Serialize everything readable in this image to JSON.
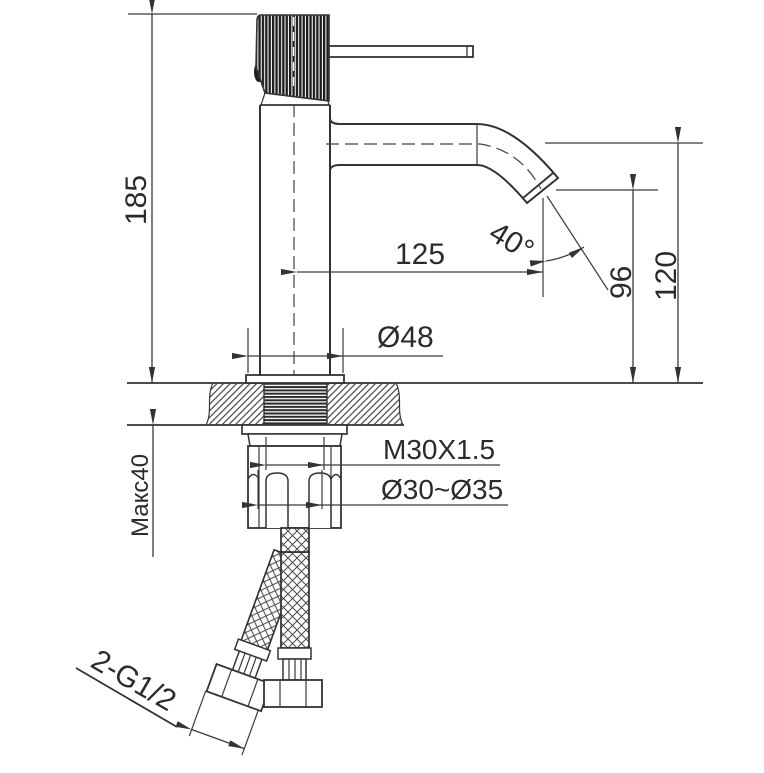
{
  "drawing": {
    "background_color": "#ffffff",
    "line_color": "#333333",
    "text_color": "#2b2b2b",
    "subject": "single-lever basin faucet, front elevation with countertop cross-section and flexible supply hoses",
    "labels": {
      "overall_height": "185",
      "spout_reach": "125",
      "spout_angle": "40°",
      "outlet_height": "96",
      "spout_centerline_height": "120",
      "base_diameter": "Ø48",
      "mounting_thread": "M30X1.5",
      "hole_diameter_range": "Ø30~Ø35",
      "max_deck_thickness": "Макс40",
      "hose_connection": "2-G1/2"
    }
  }
}
